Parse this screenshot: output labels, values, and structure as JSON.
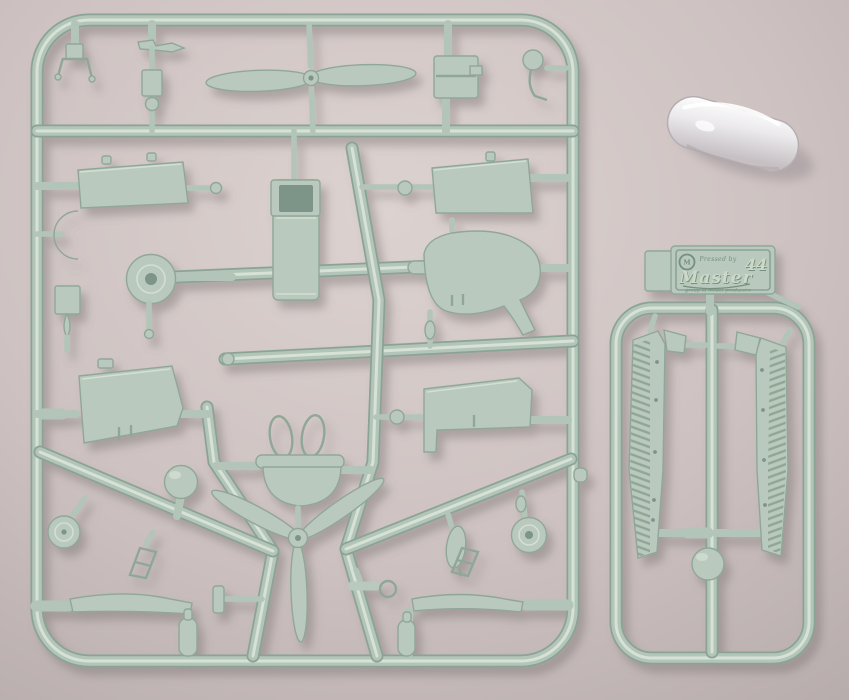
{
  "photo": {
    "caption": "Injection-moulded aircraft model kit sprues with clear canopy part"
  },
  "colors": {
    "bg": "#cdc2c1",
    "bg-light": "#dcd2cf",
    "bg-shade": "#b7acac",
    "runner-dark": "#8aa395",
    "runner-base": "#b3c5b8",
    "runner-lite": "#dde8dc",
    "part-fill": "#bac9bd",
    "part-edge": "#90a798",
    "recess": "#7d9489",
    "plaque-text": "#74907e",
    "shadow": "#6f6866",
    "canopy-hi": "#ffffff",
    "canopy-mid": "#eceaec",
    "canopy-lo": "#c6c0c3",
    "canopy-shadow": "#a49a9c"
  },
  "nameplate": {
    "pressed_by": "Pressed by",
    "scale_number": "44",
    "brand": "Master",
    "tagline": "group of model producers",
    "logo_monogram": "M"
  },
  "parts": {
    "main_sprue": [
      "two-blade propeller",
      "three-blade propeller",
      "fuselage shell",
      "engine block",
      "upper wing panels",
      "lower wing panels",
      "tail fin",
      "engine disc",
      "wheels",
      "spinner ball",
      "cowl ring with strut loops",
      "exhaust pipes",
      "crescent fairing",
      "bomb",
      "small fittings"
    ],
    "small_sprue": [
      "corrugated wing half left",
      "corrugated wing half right",
      "spinner ball",
      "maker plaque"
    ],
    "loose": [
      "clear cockpit canopy"
    ]
  }
}
